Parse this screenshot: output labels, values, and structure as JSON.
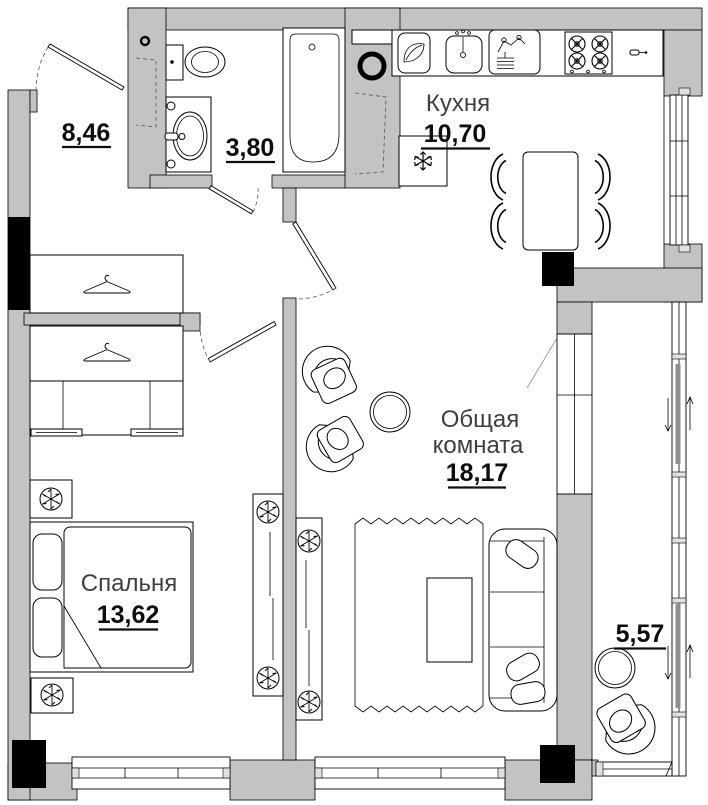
{
  "colors": {
    "background": "#ffffff",
    "wall_fill": "#c3c3c3",
    "structural_column": "#000000",
    "outline": "#000000",
    "room_name_text": "#3f3f3f",
    "room_area_text": "#0d0d0d"
  },
  "rooms": {
    "hallway": {
      "area": "8,46"
    },
    "bathroom": {
      "area": "3,80"
    },
    "kitchen": {
      "name": "Кухня",
      "area": "10,70"
    },
    "living_room": {
      "name_line1": "Общая",
      "name_line2": "комната",
      "area": "18,17"
    },
    "bedroom": {
      "name": "Спальня",
      "area": "13,62"
    },
    "balcony": {
      "area": "5,57"
    }
  },
  "icons": {
    "snowflake-icon": "❄",
    "leaf-icon": "leaf shape (vent cabinet)",
    "hanger-icon": "clothes hanger",
    "plant-icon": "potted plant (circle with spokes)",
    "pipe-riser-icon": "bold ring",
    "gas-lighter-icon": "small lighter glyph",
    "slide-arrow-icon": "up/down arrows on sliding glazing"
  },
  "fixtures": [
    "entry-door",
    "bathroom-door",
    "living-room-door",
    "bedroom-door",
    "balcony-door",
    "toilet",
    "washbasin",
    "bathtub",
    "kitchen-sink",
    "gas-water-heater",
    "gas-stove",
    "refrigerator",
    "dining-table",
    "dining-chairs",
    "hallway-wardrobe",
    "bedroom-wardrobe",
    "bed",
    "nightstands",
    "plant-shelves",
    "armchairs",
    "side-table",
    "rug",
    "coffee-table",
    "sofa",
    "balcony-table",
    "balcony-chair",
    "windows",
    "sliding-glazing"
  ]
}
